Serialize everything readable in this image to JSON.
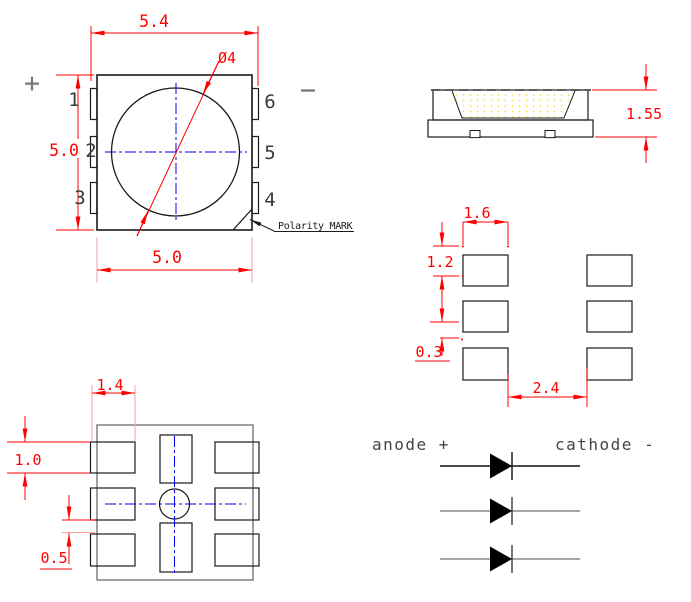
{
  "drawing_title": "SMD LED package outline drawing",
  "colors": {
    "dimension_red": "#ff0000",
    "extension_pink": "#ff9f9f",
    "centerline_blue": "#0000ee",
    "outline_black": "#1a1a1a",
    "gray": "#808080",
    "encapsulant_yellow": "#ffe84a"
  },
  "top_view": {
    "width_dim": "5.4",
    "height_dim": "5.0",
    "bottom_dim": "5.0",
    "circle_dim": "Ø4",
    "plus": "+",
    "minus": "−",
    "pin_labels": [
      "1",
      "2",
      "3",
      "4",
      "5",
      "6"
    ],
    "polarity_note": "Polarity MARK"
  },
  "side_view": {
    "height_dim": "1.55"
  },
  "pad_layout": {
    "pad_width_dim": "1.6",
    "pad_height_dim": "1.2",
    "gap_dim": "0.3",
    "span_dim": "2.4"
  },
  "bottom_view": {
    "pad_width_dim": "1.4",
    "pad_height_dim": "1.0",
    "gap_dim": "0.5"
  },
  "circuit": {
    "anode_label": "anode +",
    "cathode_label": "cathode -"
  }
}
